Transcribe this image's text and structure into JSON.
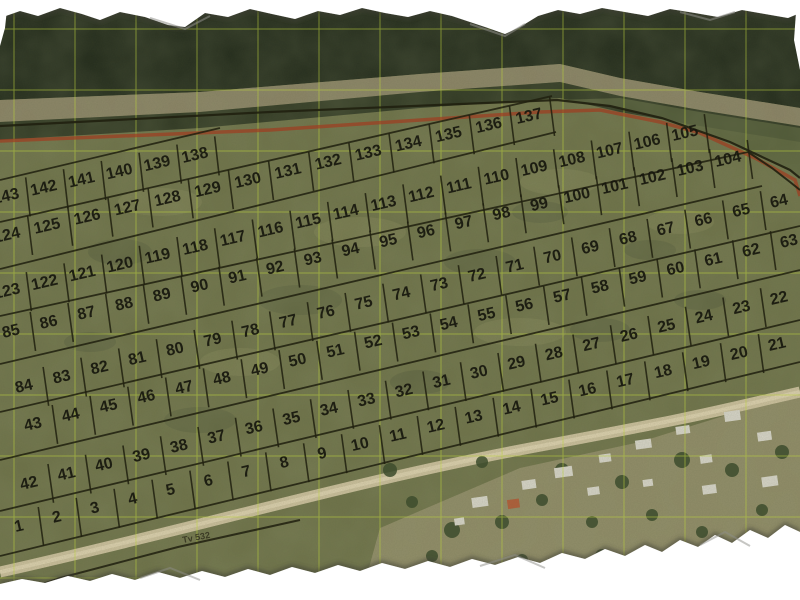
{
  "map": {
    "annotation": "Tv 532",
    "colors": {
      "grid": "#bcd23e",
      "parcel_line": "#20200f",
      "parcel_number": "#17170e",
      "red_boundary": "#a03c20",
      "road": "#cfc3a0",
      "field": "#6e7249",
      "dark_vegetation": "#222a1b",
      "shore_band": "#8e8569",
      "torn_edge": "#ffffff"
    },
    "grid": {
      "x0": 14,
      "y0": 29,
      "spacing": 61
    },
    "rows": [
      {
        "labels": [
          "1",
          "2",
          "3",
          "4",
          "5",
          "6",
          "7",
          "8",
          "9",
          "10",
          "11",
          "12",
          "13",
          "14",
          "15",
          "16",
          "17",
          "18",
          "19",
          "20",
          "21"
        ],
        "x1": 20,
        "y1": 531,
        "x2": 778,
        "y2": 349,
        "cap": false
      },
      {
        "labels": [
          "42",
          "41",
          "40",
          "39",
          "38",
          "37",
          "36",
          "35",
          "34",
          "33",
          "32",
          "31",
          "30",
          "29",
          "28",
          "27",
          "26",
          "25",
          "24",
          "23",
          "22"
        ],
        "x1": 30,
        "y1": 488,
        "x2": 780,
        "y2": 303,
        "cap": false
      },
      {
        "labels": [
          "43",
          "44",
          "45",
          "46",
          "47",
          "48",
          "49",
          "50",
          "51",
          "52",
          "53",
          "54",
          "55",
          "56",
          "57",
          "58",
          "59",
          "60",
          "61",
          "62",
          "63"
        ],
        "x1": 34,
        "y1": 429,
        "x2": 790,
        "y2": 246,
        "cap": false
      },
      {
        "labels": [
          "84",
          "83",
          "82",
          "81",
          "80",
          "79",
          "78",
          "77",
          "76",
          "75",
          "74",
          "73",
          "72",
          "71",
          "70",
          "69",
          "68",
          "67",
          "66",
          "65",
          "64"
        ],
        "x1": 25,
        "y1": 391,
        "x2": 780,
        "y2": 206,
        "cap": false
      },
      {
        "labels": [
          "85",
          "86",
          "87",
          "88",
          "89",
          "90",
          "91",
          "92",
          "93",
          "94",
          "95",
          "96",
          "97",
          "98",
          "99",
          "100",
          "101",
          "102",
          "103",
          "104"
        ],
        "x1": 12,
        "y1": 336,
        "x2": 729,
        "y2": 164,
        "cap": true
      },
      {
        "labels": [
          "123",
          "122",
          "121",
          "120",
          "119",
          "118",
          "117",
          "116",
          "115",
          "114",
          "113",
          "112",
          "111",
          "110",
          "109",
          "108",
          "107",
          "106",
          "105"
        ],
        "x1": 8,
        "y1": 296,
        "x2": 686,
        "y2": 138,
        "cap": true
      },
      {
        "labels": [
          "124",
          "125",
          "126",
          "127",
          "128",
          "129",
          "130",
          "131",
          "132",
          "133",
          "134",
          "135",
          "136",
          "137"
        ],
        "x1": 8,
        "y1": 240,
        "x2": 530,
        "y2": 121,
        "cap": true
      },
      {
        "labels": [
          "143",
          "142",
          "141",
          "140",
          "139",
          "138"
        ],
        "x1": 7,
        "y1": 201,
        "x2": 196,
        "y2": 160,
        "cap": true
      }
    ],
    "row_lines": [
      {
        "x1": 0,
        "y1": 556,
        "x2": 800,
        "y2": 362
      },
      {
        "x1": 0,
        "y1": 511,
        "x2": 800,
        "y2": 320
      },
      {
        "x1": 0,
        "y1": 460,
        "x2": 800,
        "y2": 270
      },
      {
        "x1": 0,
        "y1": 412,
        "x2": 800,
        "y2": 226
      },
      {
        "x1": 0,
        "y1": 364,
        "x2": 762,
        "y2": 186
      },
      {
        "x1": 0,
        "y1": 316,
        "x2": 748,
        "y2": 152
      },
      {
        "x1": 0,
        "y1": 269,
        "x2": 556,
        "y2": 132
      },
      {
        "x1": 0,
        "y1": 222,
        "x2": 552,
        "y2": 96
      },
      {
        "x1": 0,
        "y1": 180,
        "x2": 220,
        "y2": 128
      }
    ],
    "outline_top": "0,126 270,112 557,100 610,106 662,118 730,142 790,170 800,178",
    "right_edge": "748,152 772,168 790,182 800,190",
    "red_line": "0,141 270,130 540,112 600,110 660,122 700,133 755,158 795,180 800,196",
    "bottom_line": "8,596 60,578 178,547 300,520"
  }
}
